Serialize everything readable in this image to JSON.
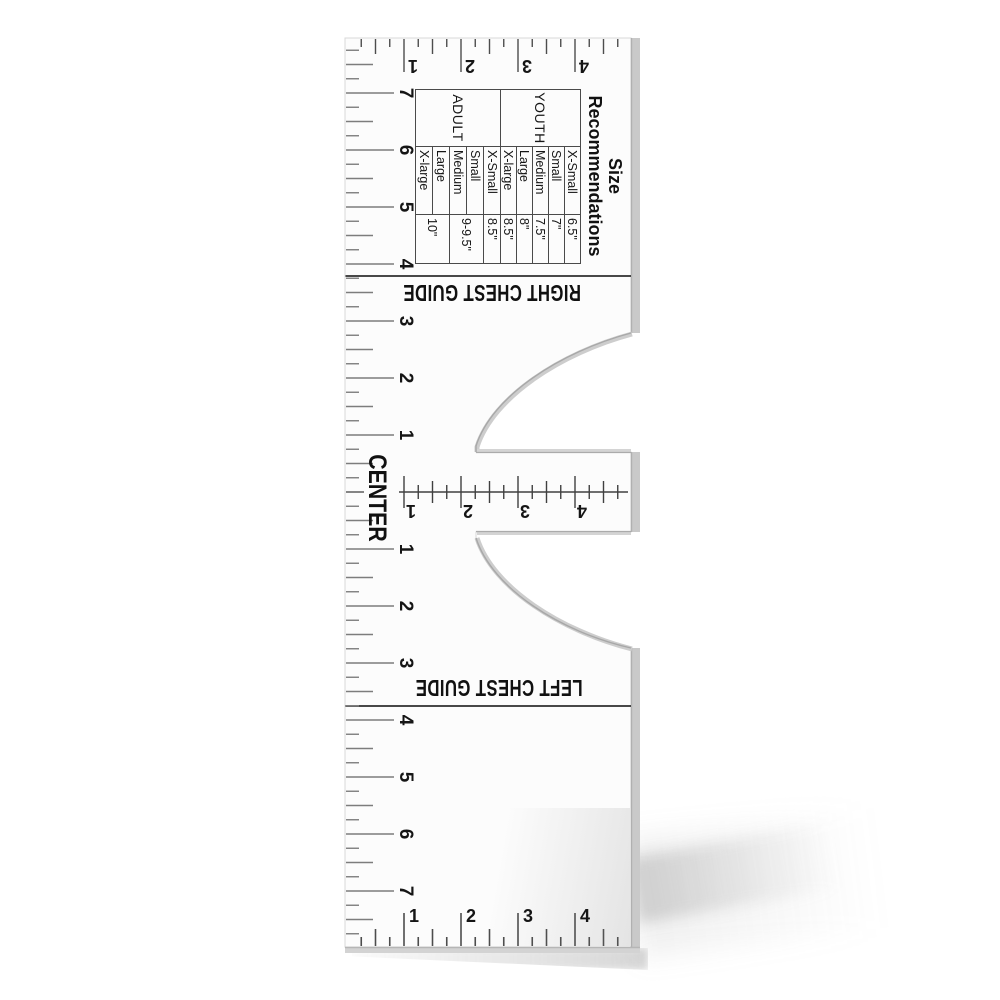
{
  "labels": {
    "right_chest_guide": "RIGHT CHEST GUIDE",
    "center": "CENTER",
    "left_chest_guide": "LEFT CHEST GUIDE"
  },
  "size_table": {
    "title_lines": [
      "Size",
      "Recommendations"
    ],
    "groups": [
      {
        "name": "YOUTH",
        "rows": [
          {
            "size": "X-Small",
            "value": "6.5\""
          },
          {
            "size": "Small",
            "value": "7\""
          },
          {
            "size": "Medium",
            "value": "7.5\""
          },
          {
            "size": "Large",
            "value": "8\""
          },
          {
            "size": "X-large",
            "value": "8.5\""
          }
        ]
      },
      {
        "name": "ADULT",
        "rows": [
          {
            "size": "X-Small",
            "value": "8.5\""
          },
          {
            "size": "Small",
            "value": "9-9.5\""
          },
          {
            "size": "Medium"
          },
          {
            "size": "Large",
            "value": "10\""
          },
          {
            "size": "X-large"
          }
        ]
      }
    ]
  },
  "scales": {
    "left_upper_numbers": [
      "7",
      "6",
      "5",
      "4",
      "3",
      "2",
      "1"
    ],
    "left_lower_numbers": [
      "1",
      "2",
      "3",
      "4",
      "5",
      "6",
      "7"
    ],
    "top_numbers": [
      "1",
      "2",
      "3",
      "4"
    ],
    "center_bar_numbers": [
      "1",
      "2",
      "3",
      "4"
    ],
    "bottom_numbers": [
      "1",
      "2",
      "3",
      "4"
    ]
  },
  "colors": {
    "body": "#fcfcfc",
    "bevel": "#c9c9c9",
    "tick_gray": "#7d7d7d",
    "ink": "#1a1a1a"
  }
}
